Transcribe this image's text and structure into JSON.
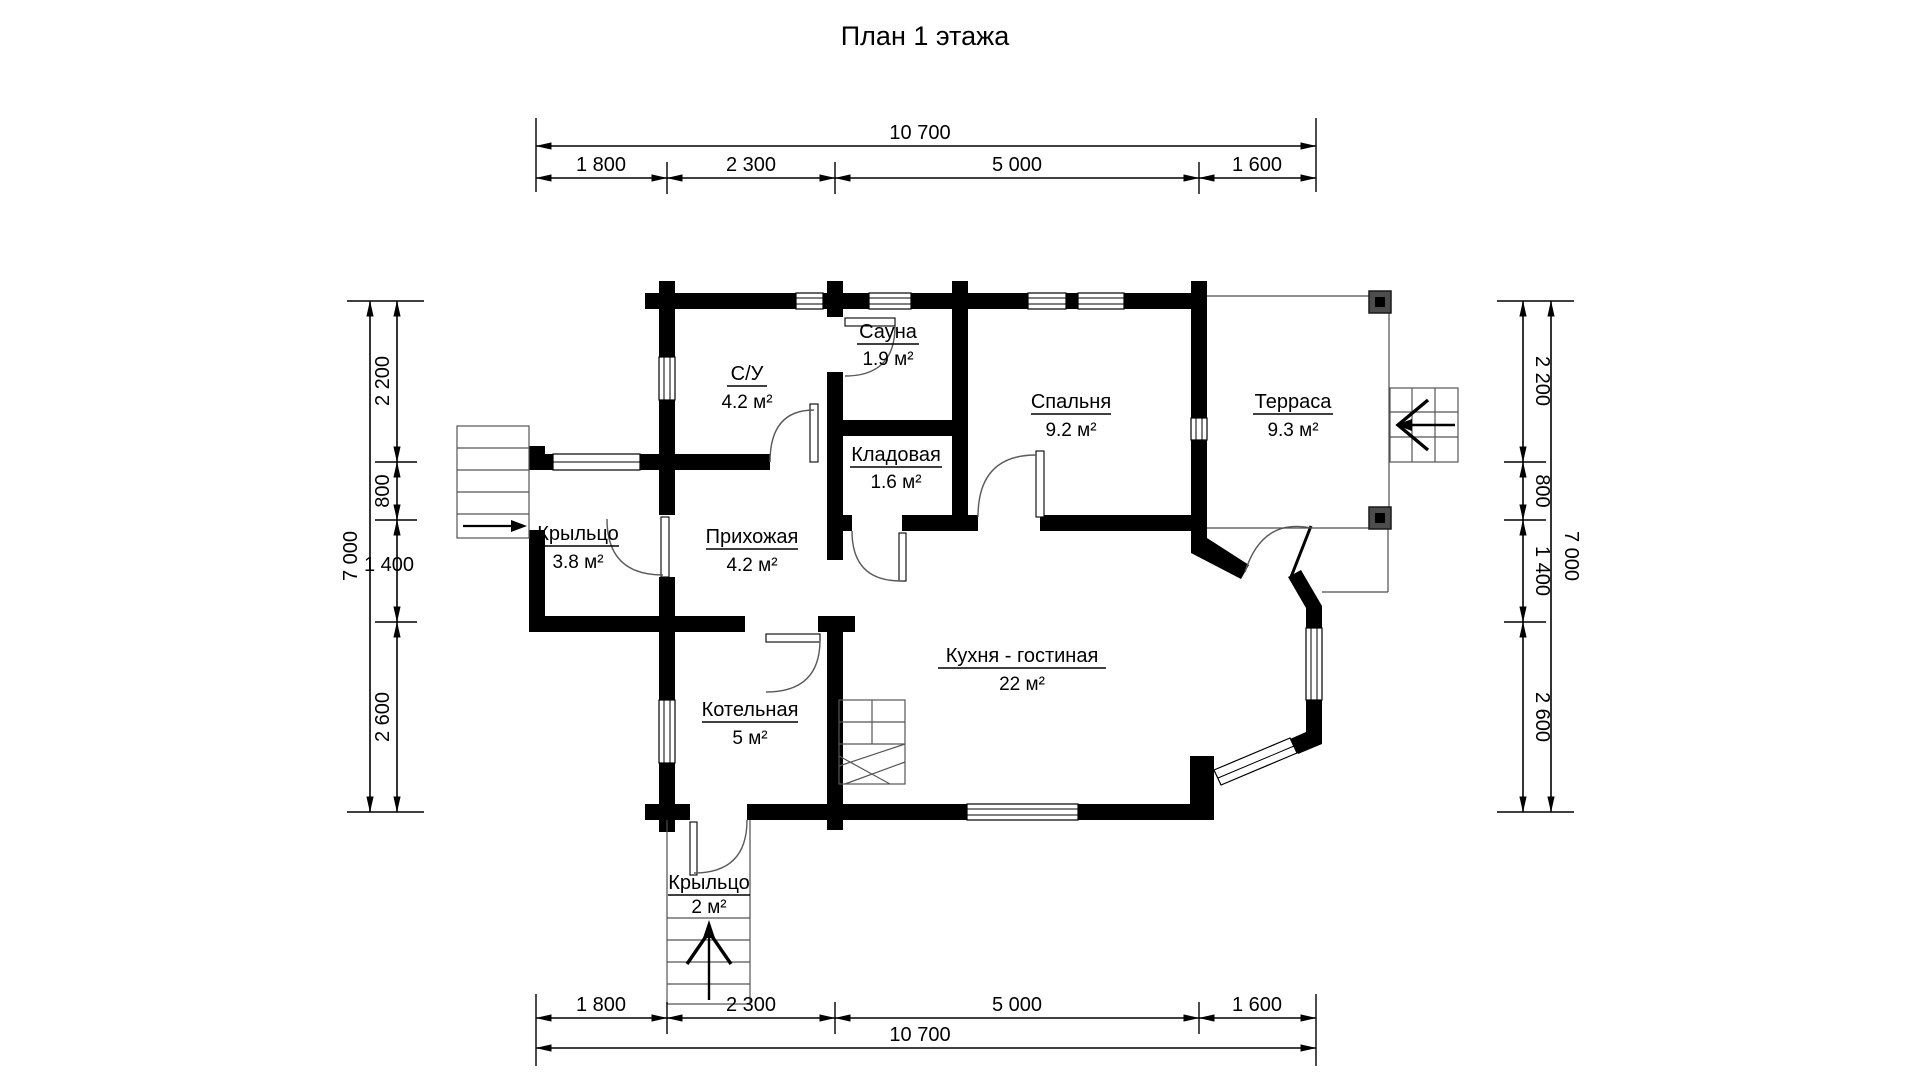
{
  "title": "План 1 этажа",
  "rooms": [
    {
      "name": "С/У",
      "area": "4.2 м²"
    },
    {
      "name": "Сауна",
      "area": "1.9 м²"
    },
    {
      "name": "Спальня",
      "area": "9.2 м²"
    },
    {
      "name": "Терраса",
      "area": "9.3 м²"
    },
    {
      "name": "Кладовая",
      "area": "1.6 м²"
    },
    {
      "name": "Крыльцо",
      "area": "3.8 м²"
    },
    {
      "name": "Прихожая",
      "area": "4.2 м²"
    },
    {
      "name": "Кухня - гостиная",
      "area": "22 м²"
    },
    {
      "name": "Котельная",
      "area": "5 м²"
    },
    {
      "name": "Крыльцо",
      "area": "2 м²"
    }
  ],
  "dimensions": {
    "top": {
      "total": "10 700",
      "segments": [
        "1 800",
        "2 300",
        "5 000",
        "1 600"
      ]
    },
    "bottom": {
      "total": "10 700",
      "segments": [
        "1 800",
        "2 300",
        "5 000",
        "1 600"
      ]
    },
    "left": {
      "total": "7 000",
      "segments": [
        "2 200",
        "800",
        "1 400",
        "2 600"
      ]
    },
    "right": {
      "total": "7 000",
      "segments": [
        "2 200",
        "800",
        "1 400",
        "2 600"
      ]
    }
  }
}
